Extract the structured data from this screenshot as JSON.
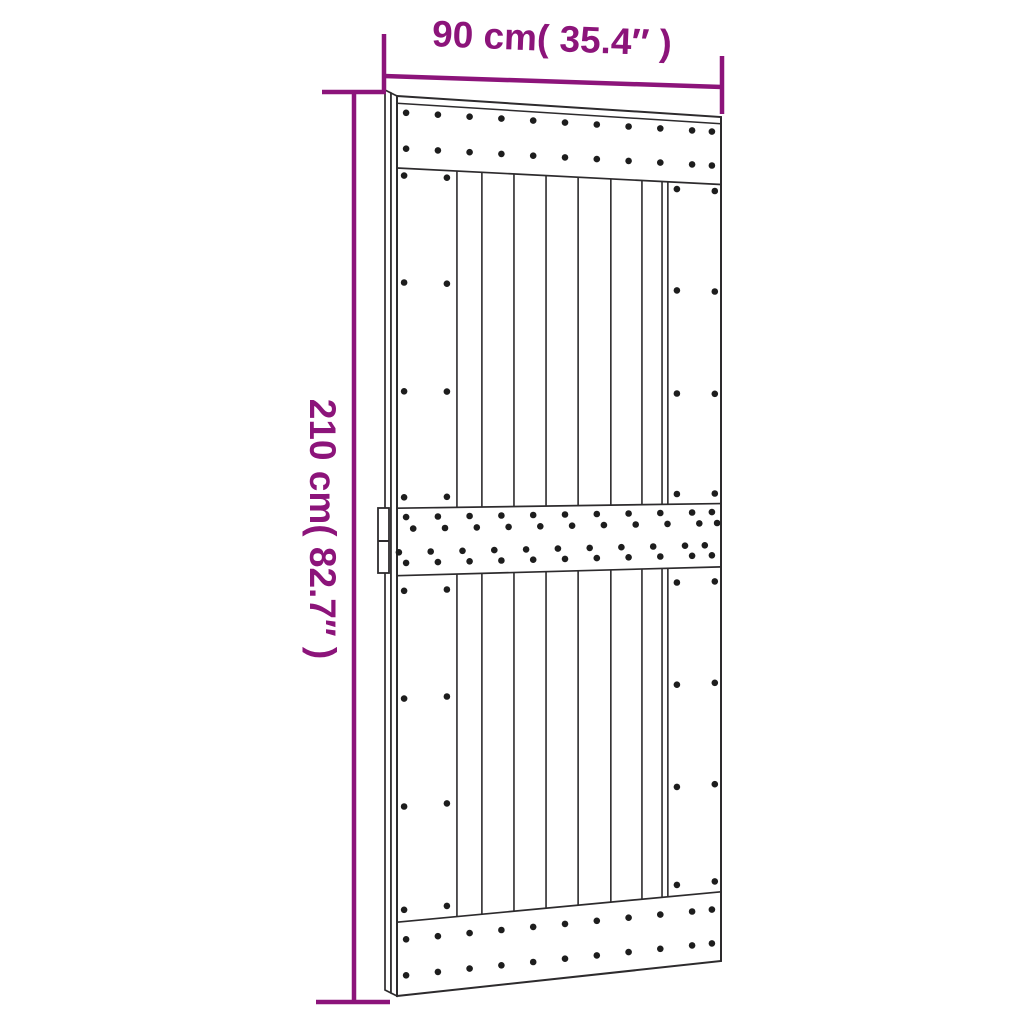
{
  "diagram": {
    "kind": "product-dimension-diagram",
    "subject": "sliding barn door with plank panels and screw-studded cross rails",
    "labels": {
      "width": "90 cm( 35.4″ )",
      "height": "210 cm( 82.7″ )"
    },
    "colors": {
      "dimension": "#8C147A",
      "outline": "#2d2b2d",
      "screws": "#1d1d1d",
      "background": "#ffffff"
    },
    "door": {
      "rails": 3,
      "planks": 7,
      "stiles": 2,
      "handle": "edge latch handle on left side"
    }
  }
}
